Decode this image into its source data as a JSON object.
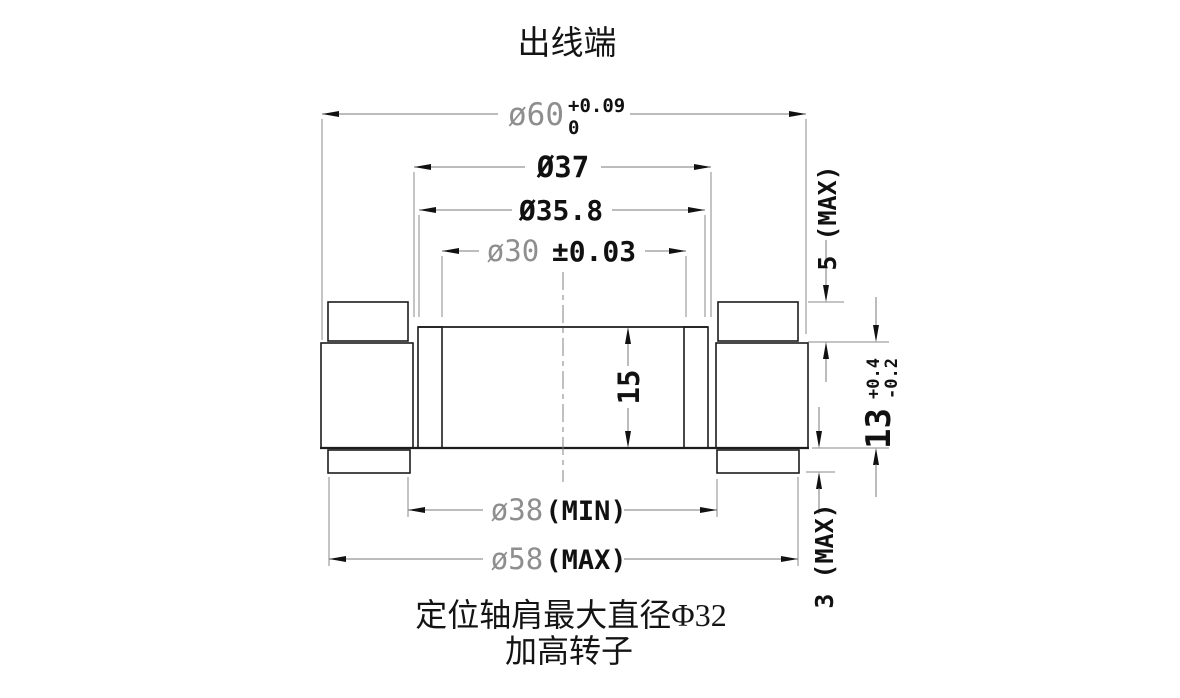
{
  "title": "出线端",
  "dims": {
    "d60": {
      "label": "ø60",
      "tol_up": "+0.09",
      "tol_dn": "0"
    },
    "d37": {
      "label": "Ø37"
    },
    "d35_8": {
      "label": "Ø35.8"
    },
    "d30": {
      "label": "ø30",
      "tol": "±0.03"
    },
    "h15": {
      "label": "15"
    },
    "h5": {
      "label": "5 (MAX)"
    },
    "h13": {
      "label": "13",
      "tol_up": "+0.4",
      "tol_dn": "-0.2"
    },
    "h3": {
      "label": "3 (MAX)"
    },
    "d38": {
      "label": "ø38",
      "qual": "(MIN)"
    },
    "d58": {
      "label": "ø58",
      "qual": "(MAX)"
    }
  },
  "notes": {
    "shoulder": "定位轴肩最大直径Φ32",
    "variant": "加高转子"
  },
  "colors": {
    "background": "#ffffff",
    "outline": "#1c1c1c",
    "hatch_line": "#6f6f6f",
    "crosshatch_line": "#555555",
    "dimension_line": "#7a7a7a",
    "arrowhead": "#111111",
    "text_primary": "#111111",
    "text_secondary": "#8e8e8e"
  }
}
